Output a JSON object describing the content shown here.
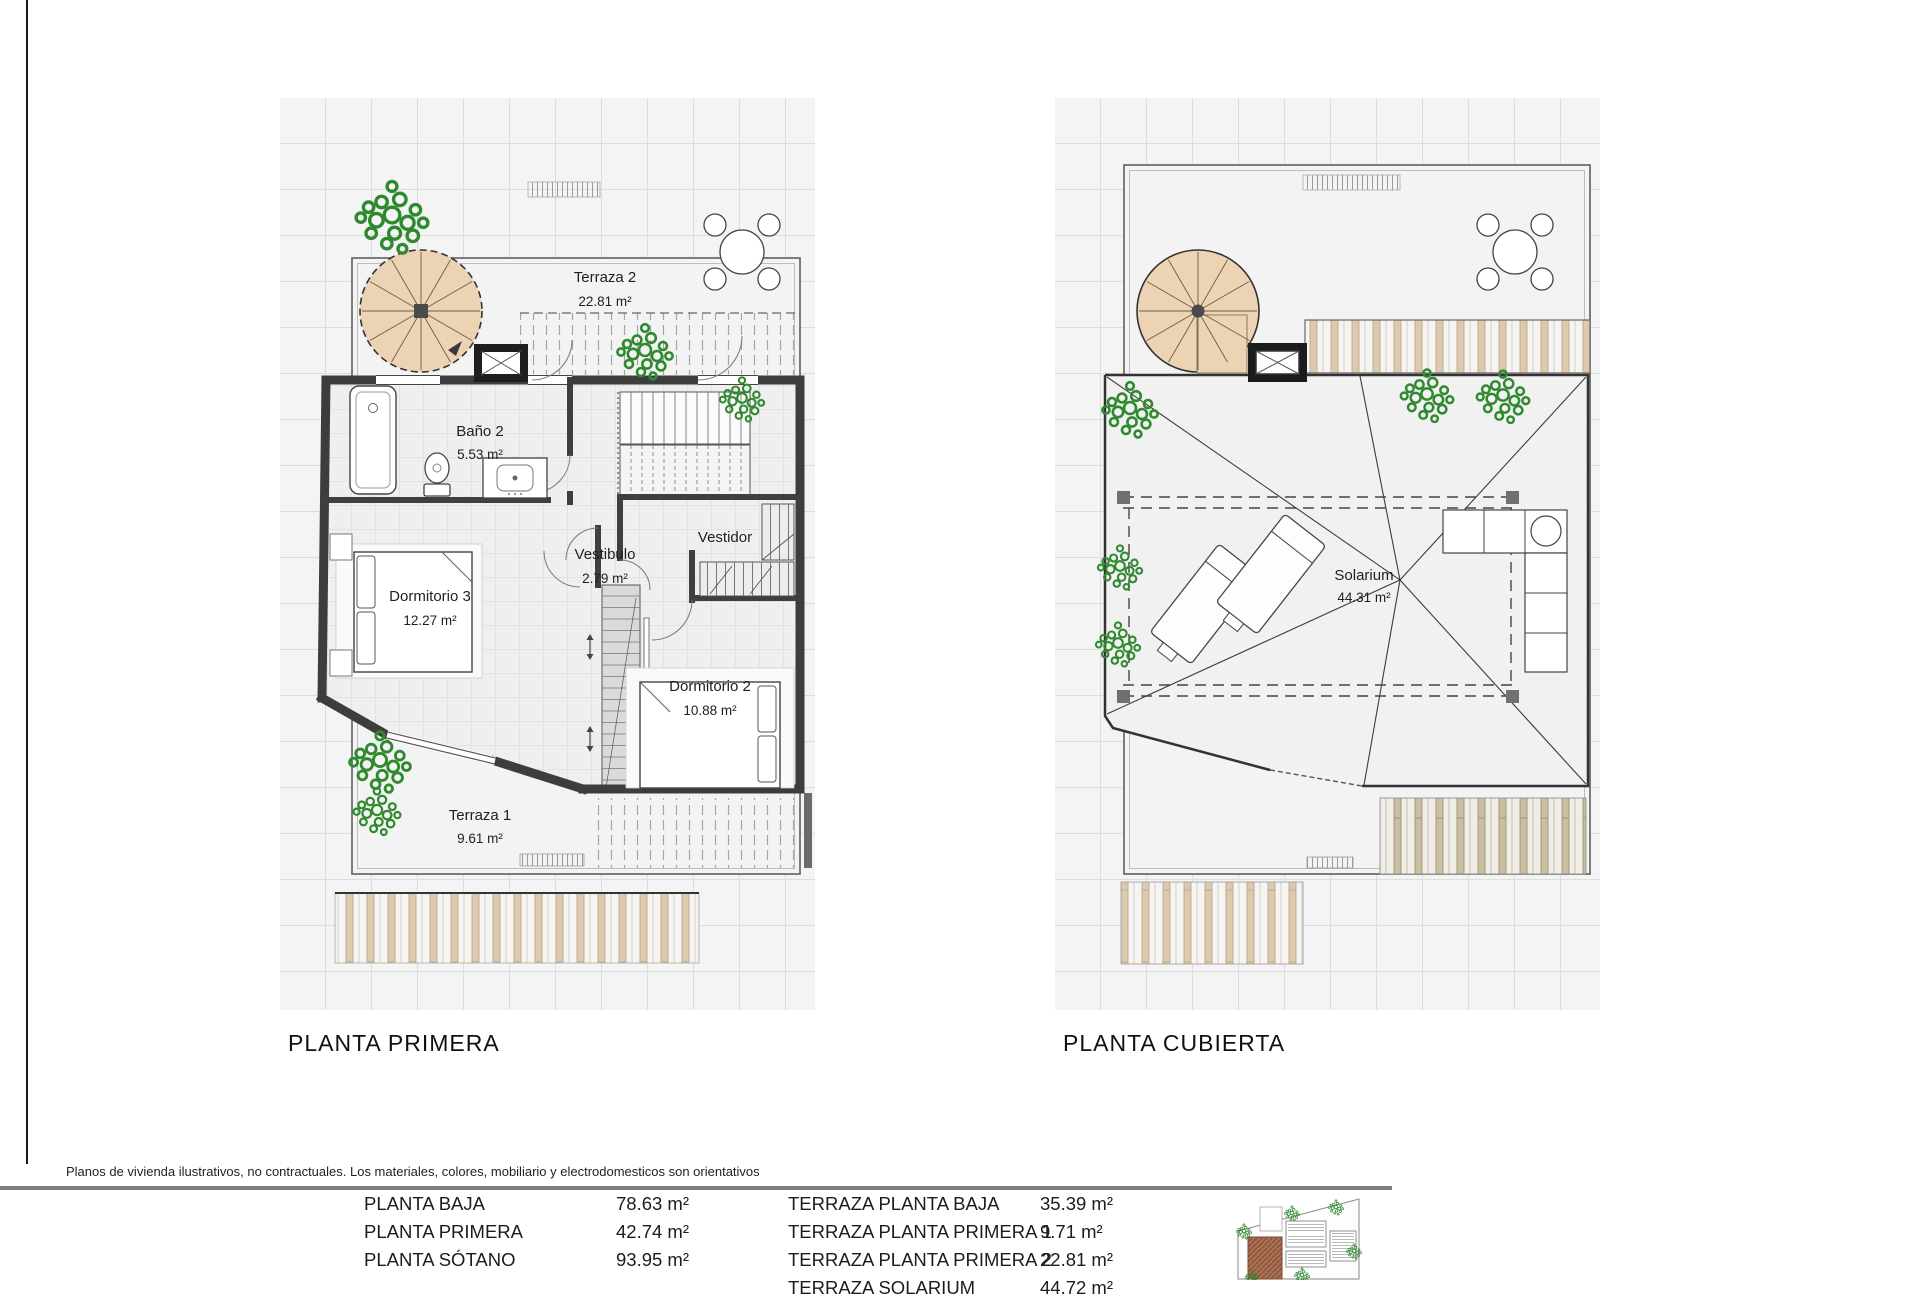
{
  "page": {
    "disclaimer": "Planos de vivienda ilustrativos, no contractuales. Los materiales, colores, mobiliario y electrodomesticos son orientativos"
  },
  "plans": {
    "left": {
      "title": "PLANTA PRIMERA",
      "rooms": {
        "terraza2": {
          "name": "Terraza 2",
          "area": "22.81 m²"
        },
        "bano2": {
          "name": "Baño 2",
          "area": "5.53 m²"
        },
        "vestibulo": {
          "name": "Vestibulo",
          "area": "2.79 m²"
        },
        "vestidor": {
          "name": "Vestidor"
        },
        "dormitorio3": {
          "name": "Dormitorio 3",
          "area": "12.27 m²"
        },
        "dormitorio2": {
          "name": "Dormitorio 2",
          "area": "10.88 m²"
        },
        "terraza1": {
          "name": "Terraza 1",
          "area": "9.61 m²"
        }
      }
    },
    "right": {
      "title": "PLANTA CUBIERTA",
      "rooms": {
        "solarium": {
          "name": "Solarium",
          "area": "44.31 m²"
        }
      }
    }
  },
  "areas_table": {
    "left_rows": [
      {
        "label": "PLANTA BAJA",
        "value": "78.63 m²"
      },
      {
        "label": "PLANTA PRIMERA",
        "value": "42.74 m²"
      },
      {
        "label": "PLANTA SÓTANO",
        "value": "93.95 m²"
      }
    ],
    "right_rows": [
      {
        "label": "TERRAZA PLANTA BAJA",
        "value": "35.39 m²"
      },
      {
        "label": "TERRAZA PLANTA PRIMERA 1",
        "value": "9.71 m²"
      },
      {
        "label": "TERRAZA PLANTA PRIMERA 2",
        "value": "22.81 m²"
      },
      {
        "label": "TERRAZA SOLARIUM",
        "value": "44.72 m²"
      }
    ]
  },
  "colors": {
    "wall": "#3d3d3d",
    "stair_wood": "#ecd3b4",
    "deck_slat": "#ddc9ad",
    "plant_green": "#2f8a2f",
    "rule_gray": "#7f7f7f"
  }
}
